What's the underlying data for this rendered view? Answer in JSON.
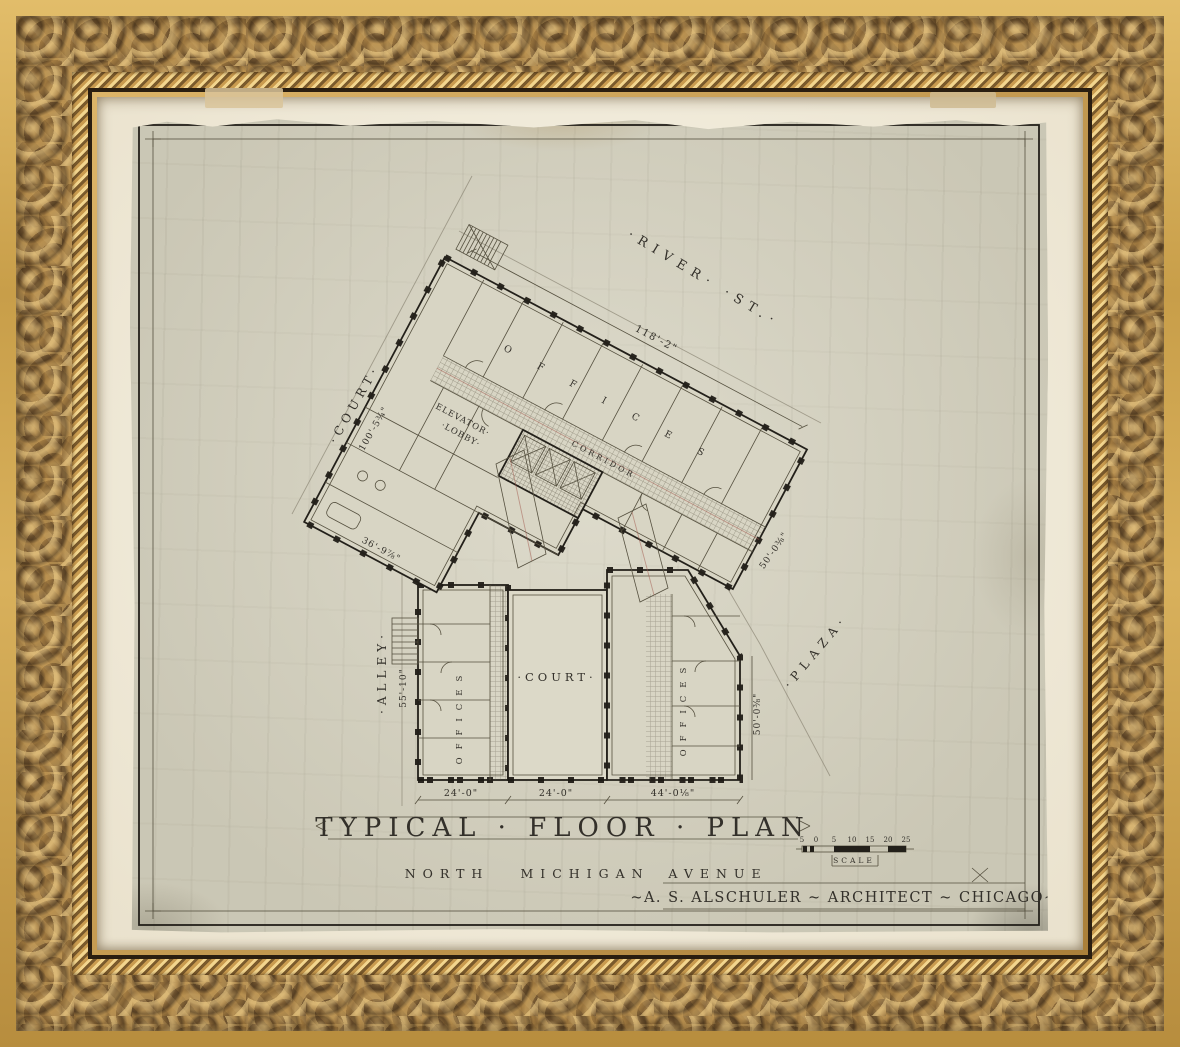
{
  "plan": {
    "title": "TYPICAL · FLOOR · PLAN",
    "address_words": [
      "NORTH",
      "MICHIGAN",
      "AVENUE"
    ],
    "architect_line": "~A. S. ALSCHULER ~ ARCHITECT ~ CHICAGO~",
    "scale": {
      "label": "SCALE",
      "ticks": [
        "5",
        "0",
        "5",
        "10",
        "15",
        "20",
        "25"
      ]
    }
  },
  "streets": {
    "river": "·RIVER·  ·ST.·",
    "court": "·COURT·",
    "alley": "·ALLEY·",
    "plaza": "·PLAZA·"
  },
  "rooms": {
    "elevator_line1": "ELEVATOR·",
    "elevator_line2": "·LOBBY·",
    "corridor": "CORRIDOR",
    "offices_upper": "OFFICES",
    "offices_left": "OFFICES",
    "offices_right": "OFFICES",
    "court": "·COURT·"
  },
  "dimensions": {
    "river_front": "118'-2\"",
    "court_side": "100'-5¾\"",
    "alley_side": "55'-10\"",
    "west_wall": "36'-9⅞\"",
    "plaza_diag": "50'-0⅜\"",
    "plaza_vert": "50'-0⅜\"",
    "bottom_left": "24'-0\"",
    "bottom_mid": "24'-0\"",
    "bottom_right": "44'-0⅛\""
  }
}
